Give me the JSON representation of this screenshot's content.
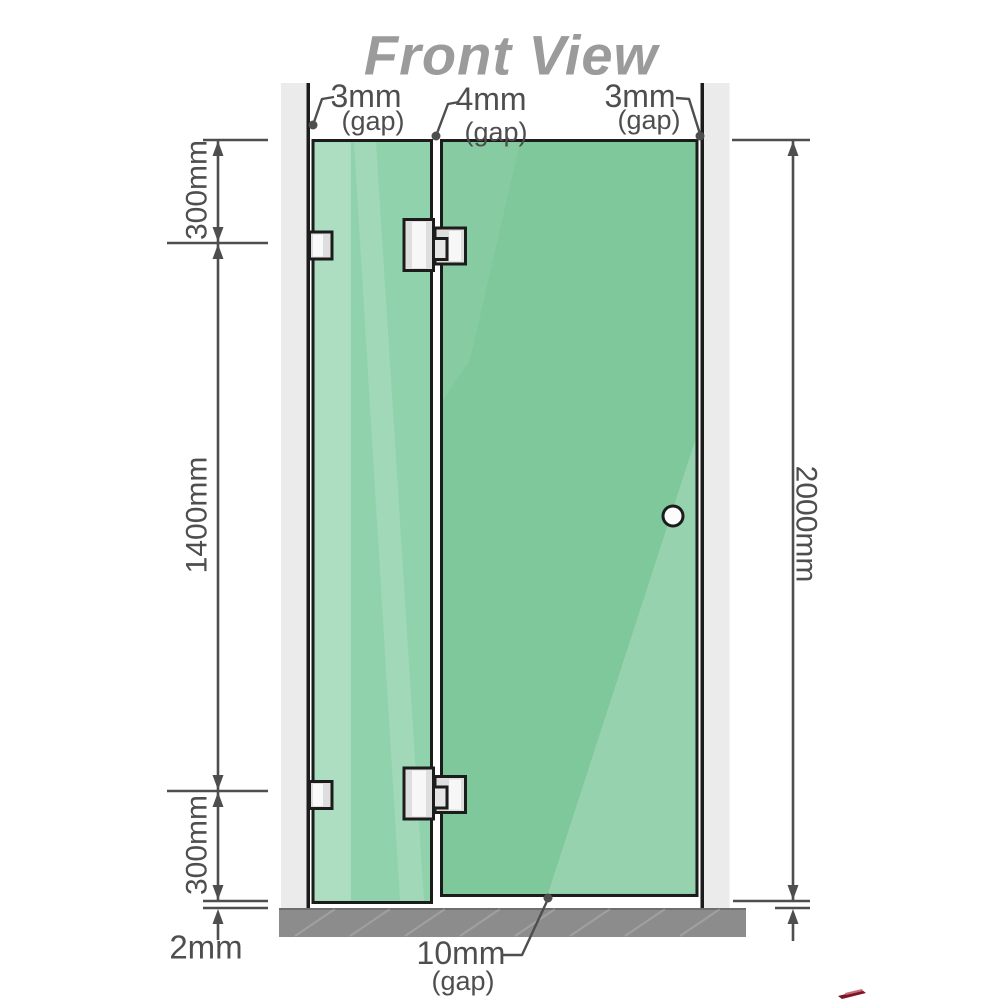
{
  "title": "Front View",
  "labels": {
    "gap_top_left": {
      "value": "3mm",
      "suffix": "(gap)"
    },
    "gap_top_middle": {
      "value": "4mm",
      "suffix": "(gap)"
    },
    "gap_top_right": {
      "value": "3mm",
      "suffix": "(gap)"
    },
    "gap_bottom": {
      "value": "10mm",
      "suffix": "(gap)"
    },
    "dim_top_section": "300mm",
    "dim_middle_section": "1400mm",
    "dim_bottom_section": "300mm",
    "dim_floor_clearance": "2mm",
    "dim_total_height": "2000mm"
  },
  "colors": {
    "glass_fixed_panel": "#8fd2ab",
    "glass_door_panel": "#7ec89b",
    "wall": "#ebebeb",
    "floor": "#8c8c8c",
    "outline": "#1c1c1c",
    "dimension_lines": "#4e4e4e",
    "title_text": "#9b9b9b",
    "hardware": "#e0e0e0",
    "logo_fragment_red": "#7d1525"
  }
}
